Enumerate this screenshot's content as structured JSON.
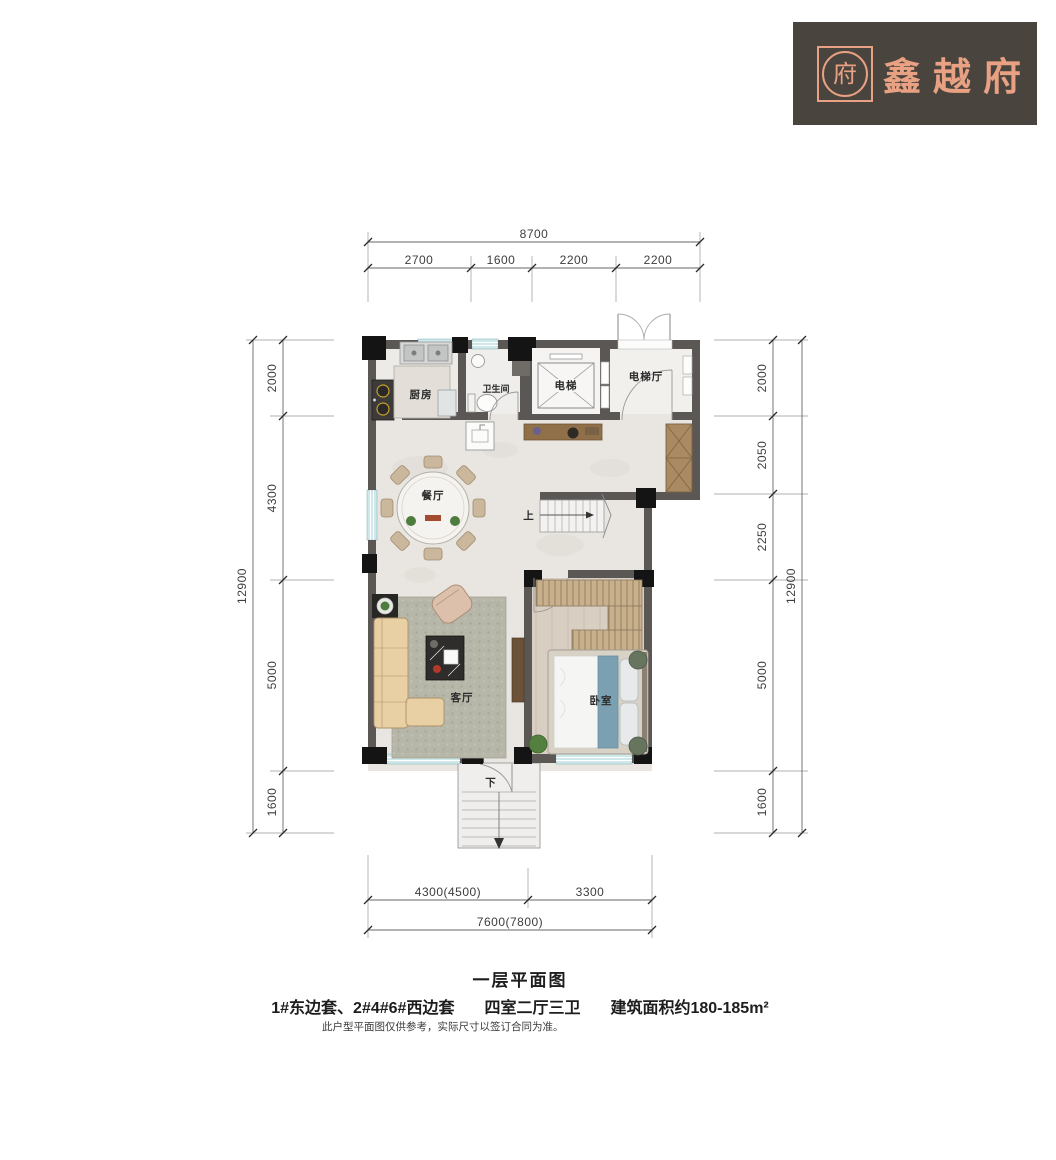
{
  "logo": {
    "brand": "鑫越府",
    "emblem_char": "府",
    "bg_color": "#4a443e",
    "accent_color": "#e8a183"
  },
  "floor_plan": {
    "rooms": {
      "kitchen": "厨房",
      "bathroom": "卫生间",
      "elevator": "电梯",
      "elevator_hall": "电梯厅",
      "dining": "餐厅",
      "living": "客厅",
      "bedroom": "卧室",
      "stairs_up": "上",
      "stairs_down": "下"
    },
    "dimensions_mm": {
      "top": {
        "total": "8700",
        "segments": [
          "2700",
          "1600",
          "2200",
          "2200"
        ]
      },
      "left": {
        "total": "12900",
        "segments": [
          "2000",
          "4300",
          "5000",
          "1600"
        ]
      },
      "right": {
        "total": "12900",
        "segments": [
          "2000",
          "2050",
          "2250",
          "5000",
          "1600"
        ]
      },
      "bottom": {
        "total": "7600(7800)",
        "segments": [
          "4300(4500)",
          "3300"
        ]
      }
    },
    "colors": {
      "wall": "#5b5755",
      "column": "#141414",
      "window": "#cfe9ea",
      "bedroom_floor": "#d9cec2"
    }
  },
  "caption": {
    "title": "一层平面图",
    "units": "1#东边套、2#4#6#西边套",
    "layout": "四室二厅三卫",
    "area": "建筑面积约180-185m²",
    "disclaimer": "此户型平面图仅供参考，实际尺寸以签订合同为准。"
  }
}
